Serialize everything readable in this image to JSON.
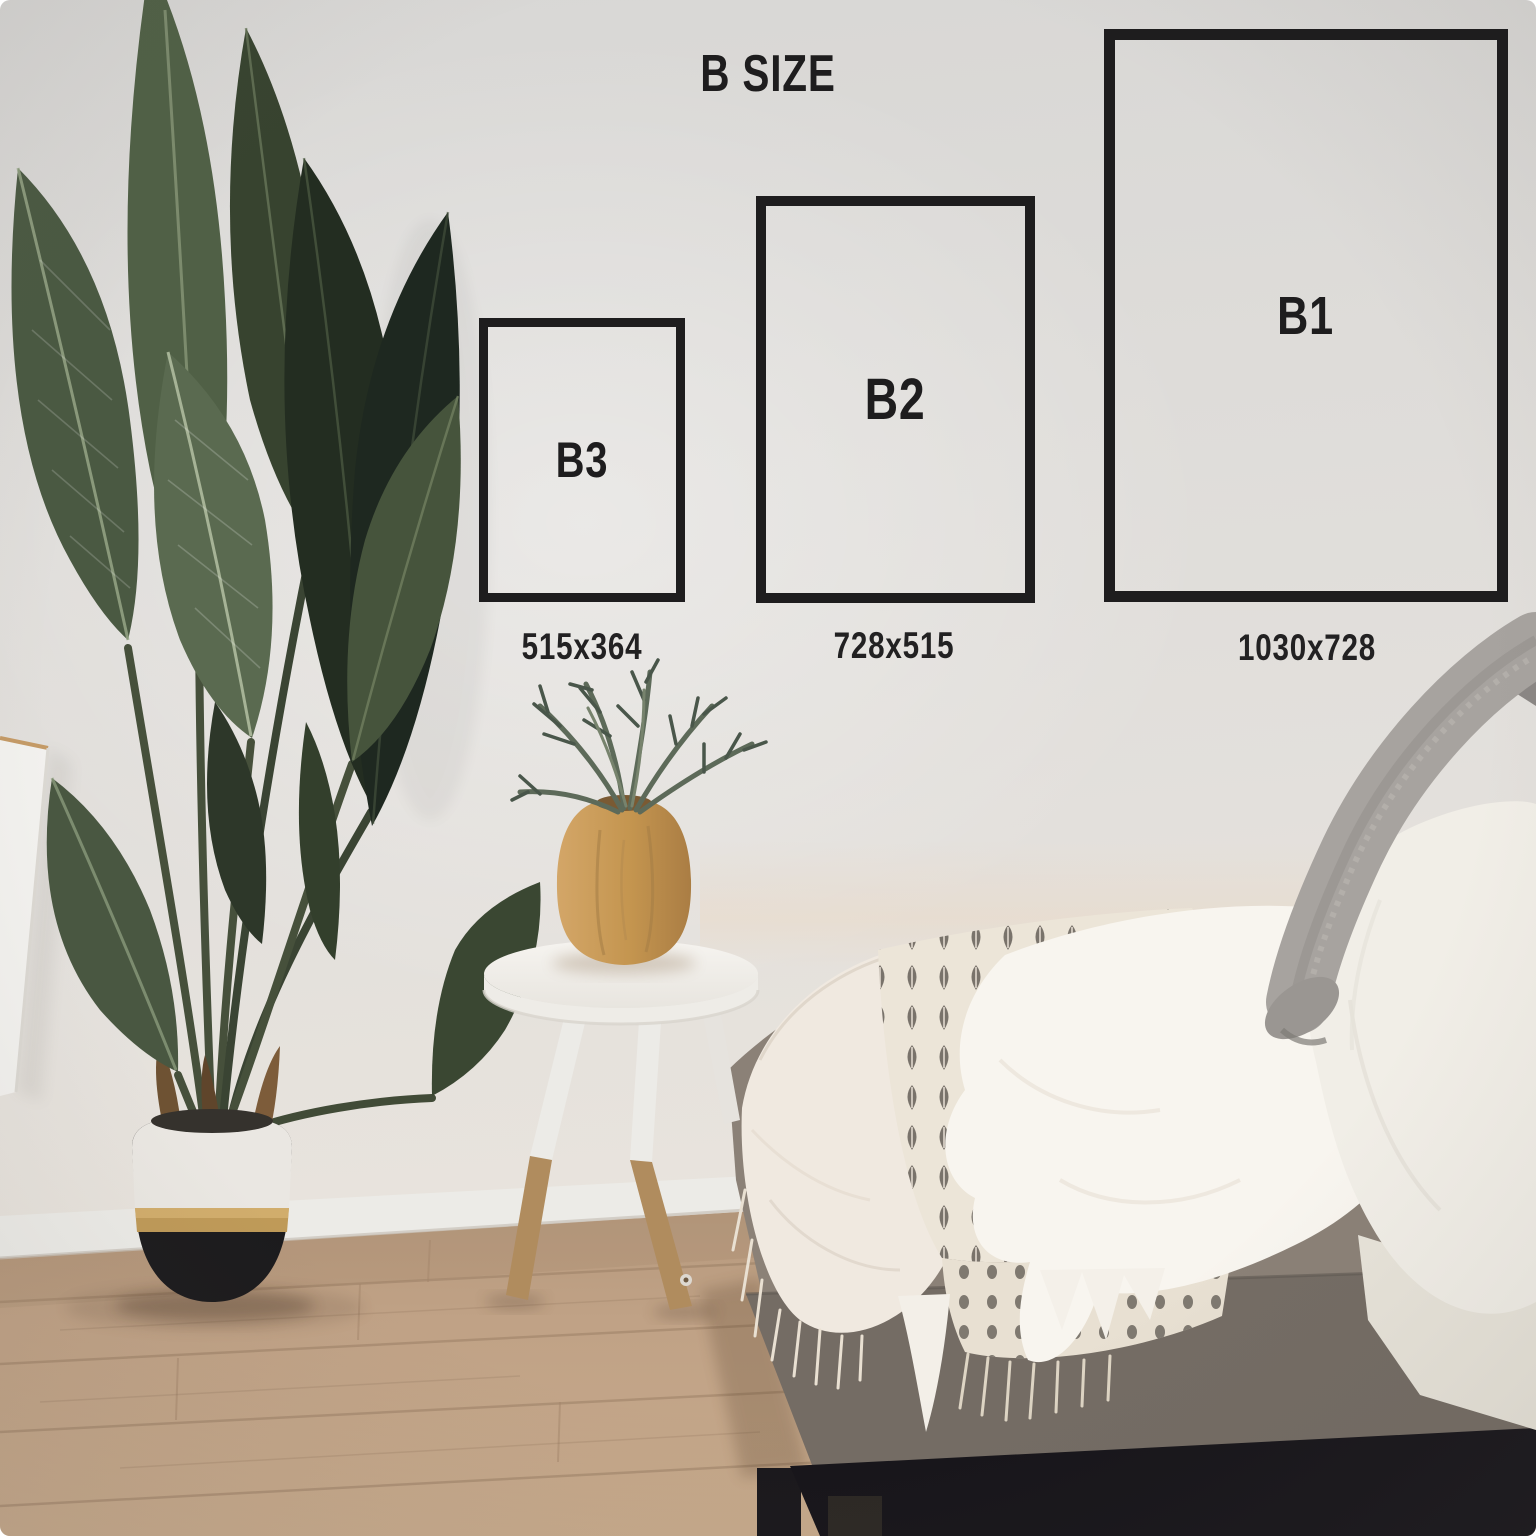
{
  "size_chart": {
    "title": "B SIZE",
    "sizes": [
      {
        "name": "B3",
        "dimensions": "515x364"
      },
      {
        "name": "B2",
        "dimensions": "728x515"
      },
      {
        "name": "B1",
        "dimensions": "1030x728"
      }
    ]
  },
  "colors": {
    "ink": "#1e1d1e",
    "wall": "#e0ddd9",
    "floor_wood": "#bda085",
    "plant_green_mid": "#46543c",
    "plant_green_dark": "#232d21",
    "pot_white": "#eae7e2",
    "pot_gold": "#bf9a58",
    "pot_black": "#1c1b1d",
    "stool_white": "#f3f1ed",
    "stool_wood": "#b08c5e",
    "vase_wood": "#c89a5e",
    "sofa_gray": "#8b8177",
    "sofa_front_gray": "#746c64",
    "bed_base_black": "#17151a",
    "muslin_cream": "#f0e9e0",
    "throw_cream": "#ece5d8",
    "throw_motif": "#56504a",
    "sheepskin_white": "#f8f5ef",
    "sherpa_white": "#f1eee7",
    "knit_gray": "#a7a39f"
  },
  "photo_objects": [
    "bird-of-paradise-plant",
    "two-tone-planter-pot",
    "wall-mounted-cabinet",
    "wood-floor",
    "baseboard",
    "round-side-table",
    "wooden-vase",
    "fern-plant",
    "gray-daybed",
    "white-muslin-blanket",
    "block-print-throw",
    "sheepskin-blanket",
    "sherpa-pillow",
    "gray-knit-throw",
    "black-bed-base"
  ]
}
